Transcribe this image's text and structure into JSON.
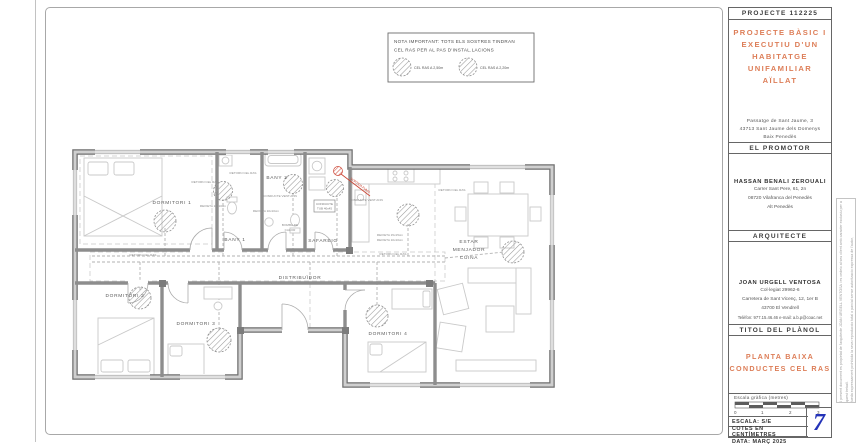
{
  "colors": {
    "accent_orange": "#dd7e58",
    "sheet_number_blue": "#2433b8",
    "wall_gray": "#7a7a7a",
    "danger_red": "#cc4433"
  },
  "titleblock": {
    "project_code": "PROJECTE 112225",
    "project_title_lines": [
      "PROJECTE BÀSIC I",
      "EXECUTIU D'UN",
      "HABITATGE UNIFAMILIAR",
      "AÏLLAT"
    ],
    "project_address_lines": [
      "Passatge de Sant Jaume, 3",
      "43713 Sant Jaume dels Domenys",
      "Baix Penedès"
    ],
    "promoter_header": "EL PROMOTOR",
    "promoter_name": "HASSAN BENALI ZEROUALI",
    "promoter_lines": [
      "Carrer Sant Pere, 61, 2n",
      "08720 Vilafranca del Penedès",
      "Alt Penedès"
    ],
    "architect_header": "ARQUITECTE",
    "architect_name": "JOAN URGELL VENTOSA",
    "architect_lines": [
      "Col·legiat 29962-6",
      "Carretera de Sant Vicenç, 12, 1er B",
      "43700 El Vendrell"
    ],
    "architect_contact": "Telèfon: 977.15.46.46   e-mail: a.b.p@coac.net",
    "plan_title_header": "TITOL DEL PLÀNOL",
    "plan_title_lines": [
      "PLANTA BAIXA",
      "CONDUCTES CEL RAS"
    ],
    "scale_caption": "Escala gràfica (metres)",
    "scale_ticks": [
      "0",
      "1",
      "2",
      "3"
    ],
    "footer_escala": "ESCALA: S/E",
    "footer_cotes": "COTES EN CENTÍMETRES",
    "footer_data": "DATA: MARÇ 2025",
    "sheet_number": "7",
    "side_note_lines": [
      "El present document es propietat de l'arquitecte JOAN URGELL VENTOSA i es cedeix al seu client amb caracter exclusiu per a aquest treball.",
      "Queda expressament prohibida la seva reproduccio total o parcial sense autoritzacio expressa de l'autor,",
      "aixi com la seva utilitzacio per a qualsevol finalitat diferent de l'expressada."
    ]
  },
  "note_box": {
    "line1": "NOTA IMPORTANT: TOTS ELS SOSTRES TINDRAN",
    "line2": "CEL RAS PER AL PAS D'INSTAL.LACIONS",
    "legend_1": "CEL RAS A 2,50m",
    "legend_2": "CEL RAS A 2,20m"
  },
  "plan": {
    "rooms": {
      "dormitori1": "DORMITORI 1",
      "dormitori2": "DORMITORI 2",
      "dormitori3": "DORMITORI 3",
      "dormitori4": "DORMITORI 4",
      "bany1": "BANY 1",
      "bany2": "BANY 2",
      "safareig": "SAFAREIG",
      "distribuidor": "DISTRIBUÏDOR",
      "estar_line1": "ESTAR",
      "estar_line2": "MENJADOR",
      "estar_line3": "CUINA"
    },
    "labels": {
      "retorn": "RETORN CEL RAS",
      "reixeta10": "REIXETA 10x10cm",
      "reixeta15": "REIXETA 15x15cm",
      "conducte_vent": "CONDUCTE VENT.ANN",
      "bomba1": "BOMBA DE",
      "bomba2": "CALOR",
      "conducte_tub1": "CONDUCTE",
      "conducte_tub2": "TUB 40x45",
      "sortida_fums": "SORTIDA FUMS"
    }
  }
}
